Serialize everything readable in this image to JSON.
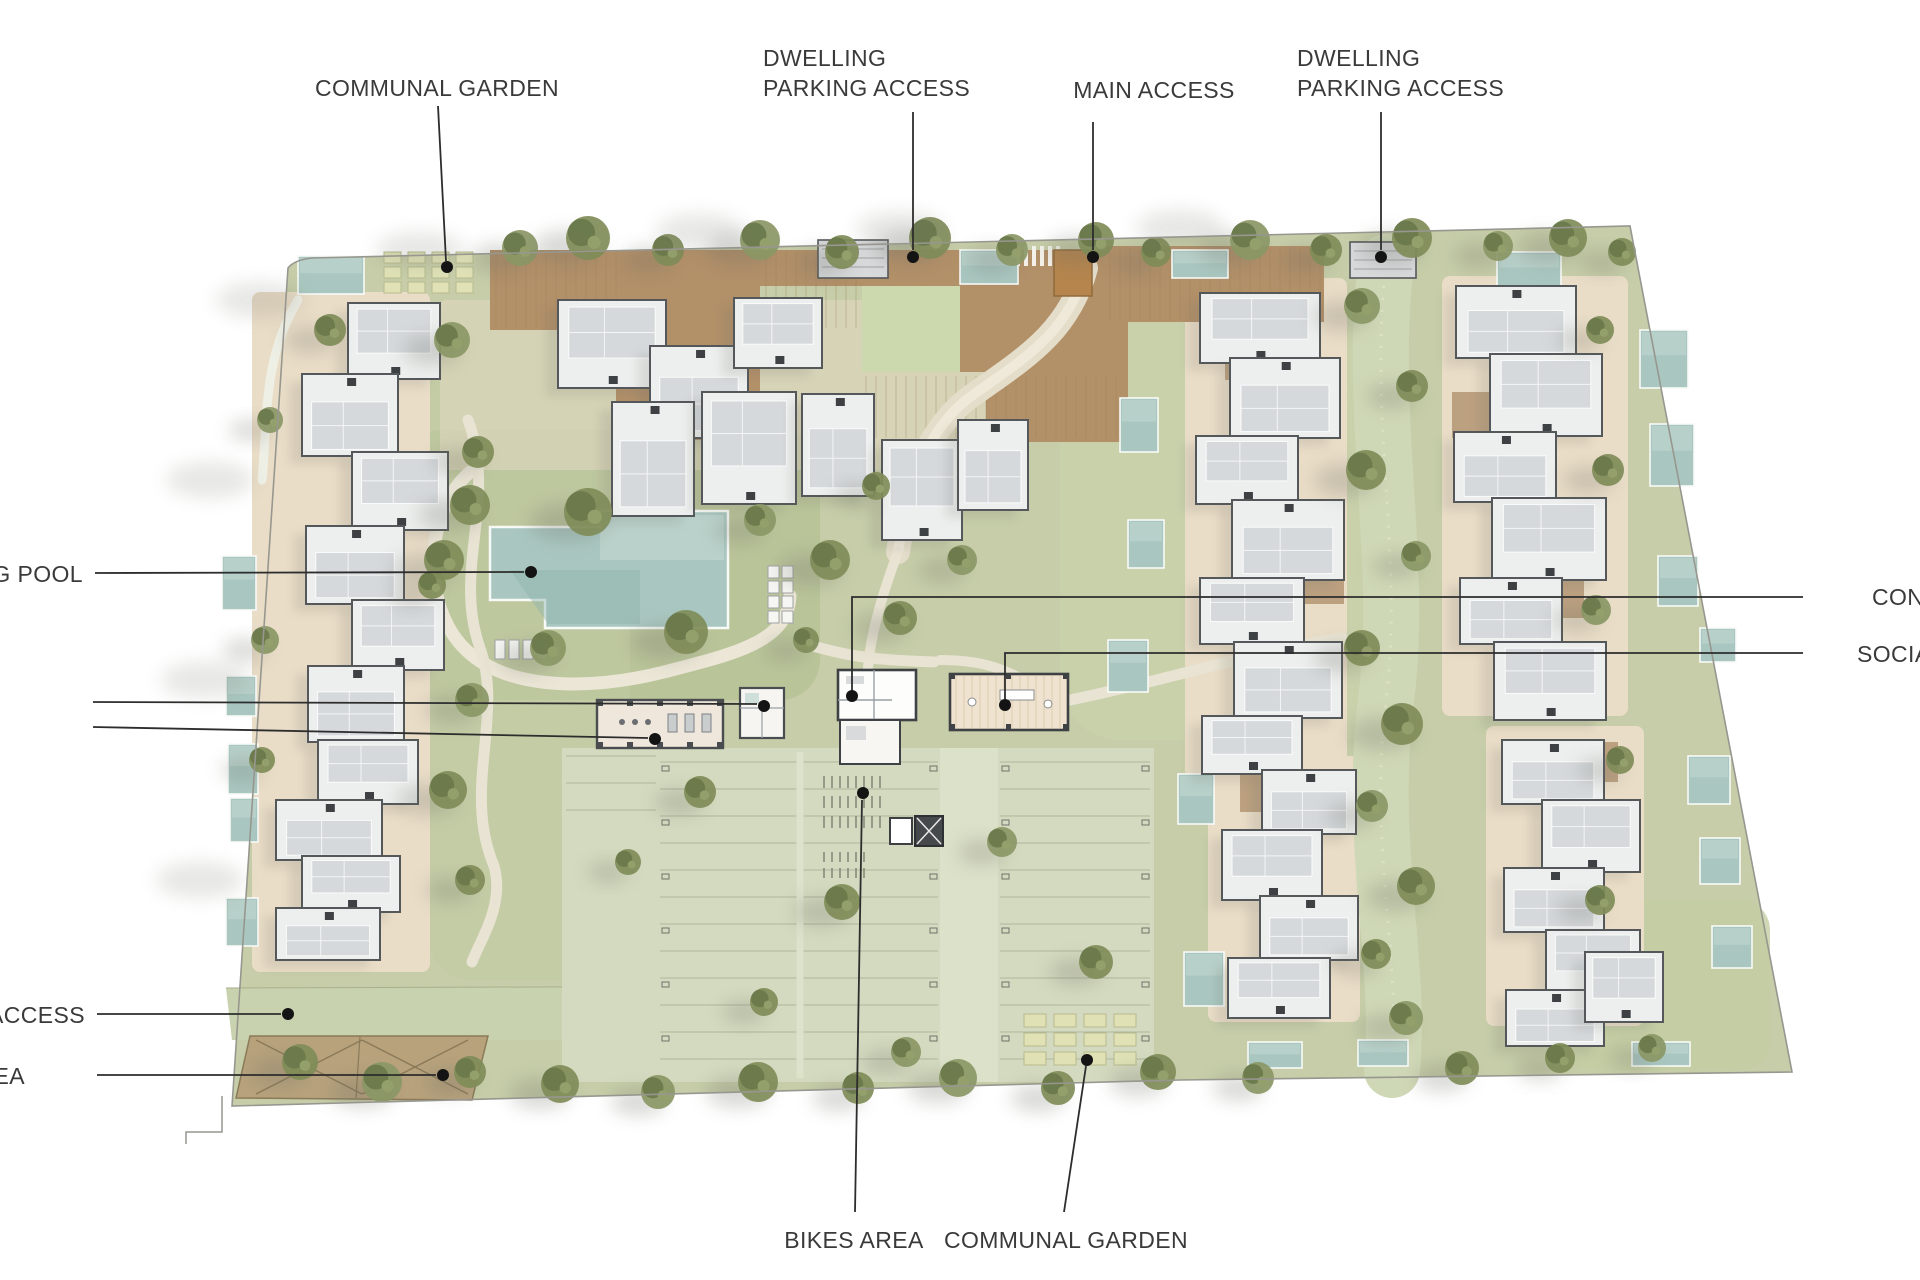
{
  "figure": {
    "kind": "residential masterplan site plan, top view render",
    "background": "#ffffff"
  },
  "palette": {
    "label_text": "#3a3a3a",
    "leader_line": "#2d2d2d",
    "dot": "#141414",
    "ground": "#c6cda8",
    "lawn": "#b6c296",
    "parking_surface": "#d4dabf",
    "path_cream": "#ebe6d6",
    "terrace_beige": "#e9ddc7",
    "deck_brown": "#b29068",
    "spine_green": "#cfd8b6",
    "pool_water": "#a9c7c0",
    "pool_light": "#c6d9d2",
    "building_fill": "#edefee",
    "building_roof": "#d5d9db",
    "building_stroke": "#54585a",
    "tree_green": "#7f8c58",
    "tree_dark": "#69784a",
    "shadow": "#6d6d66",
    "beds_fill": "#e0e2b6",
    "gate_orange": "#b5854d",
    "boundary": "#97978f"
  },
  "annotations": [
    {
      "name": "label-communal-garden-top",
      "lines": [
        "COMMUNAL GARDEN"
      ],
      "tx": 437,
      "ty": 88,
      "anchor": "middle",
      "leader": [
        [
          438,
          106
        ],
        [
          446,
          261
        ]
      ],
      "dot": [
        447,
        267
      ]
    },
    {
      "name": "label-dwelling-parking-access-left",
      "lines": [
        "DWELLING",
        "PARKING ACCESS"
      ],
      "tx": 763,
      "ty": 58,
      "anchor": "start",
      "leader": [
        [
          913,
          112
        ],
        [
          913,
          250
        ]
      ],
      "dot": [
        913,
        257
      ]
    },
    {
      "name": "label-main-access",
      "lines": [
        "MAIN ACCESS"
      ],
      "tx": 1154,
      "ty": 90,
      "anchor": "middle",
      "leader": [
        [
          1093,
          122
        ],
        [
          1093,
          250
        ]
      ],
      "dot": [
        1093,
        257
      ]
    },
    {
      "name": "label-dwelling-parking-access-right",
      "lines": [
        "DWELLING",
        "PARKING ACCESS"
      ],
      "tx": 1297,
      "ty": 58,
      "anchor": "start",
      "leader": [
        [
          1381,
          112
        ],
        [
          1381,
          250
        ]
      ],
      "dot": [
        1381,
        257
      ]
    },
    {
      "name": "label-swimming-pool",
      "lines": [
        "NG POOL"
      ],
      "tx": 83,
      "ty": 574,
      "anchor": "end",
      "leader": [
        [
          95,
          573
        ],
        [
          524,
          572
        ]
      ],
      "dot": [
        531,
        572
      ]
    },
    {
      "name": "label-concierge",
      "lines": [
        "CON"
      ],
      "tx": 1872,
      "ty": 597,
      "anchor": "start",
      "leader": [
        [
          1803,
          597
        ],
        [
          852,
          597
        ],
        [
          852,
          690
        ]
      ],
      "dot": [
        852,
        696
      ]
    },
    {
      "name": "label-social-club",
      "lines": [
        "SOCIA"
      ],
      "tx": 1857,
      "ty": 654,
      "anchor": "start",
      "leader": [
        [
          1803,
          653
        ],
        [
          1005,
          653
        ],
        [
          1005,
          699
        ]
      ],
      "dot": [
        1005,
        705
      ]
    },
    {
      "name": "leader-amenity-upper",
      "lines": [],
      "leader": [
        [
          93,
          702
        ],
        [
          757,
          704
        ]
      ],
      "dot": [
        764,
        706
      ]
    },
    {
      "name": "leader-amenity-lower",
      "lines": [],
      "leader": [
        [
          93,
          727
        ],
        [
          648,
          738
        ]
      ],
      "dot": [
        655,
        739
      ]
    },
    {
      "name": "label-access",
      "lines": [
        "ACCESS"
      ],
      "tx": 85,
      "ty": 1015,
      "anchor": "end",
      "leader": [
        [
          97,
          1014
        ],
        [
          281,
          1014
        ]
      ],
      "dot": [
        288,
        1014
      ]
    },
    {
      "name": "label-area",
      "lines": [
        "EA"
      ],
      "tx": 25,
      "ty": 1076,
      "anchor": "end",
      "leader": [
        [
          97,
          1075
        ],
        [
          436,
          1075
        ]
      ],
      "dot": [
        443,
        1075
      ]
    },
    {
      "name": "label-bikes-area",
      "lines": [
        "BIKES AREA"
      ],
      "tx": 854,
      "ty": 1240,
      "anchor": "middle",
      "leader": [
        [
          855,
          1212
        ],
        [
          862,
          800
        ]
      ],
      "dot": [
        863,
        793
      ]
    },
    {
      "name": "label-communal-garden-bottom",
      "lines": [
        "COMMUNAL GARDEN"
      ],
      "tx": 1066,
      "ty": 1240,
      "anchor": "middle",
      "leader": [
        [
          1064,
          1212
        ],
        [
          1086,
          1066
        ]
      ],
      "dot": [
        1087,
        1060
      ]
    }
  ],
  "features": [
    "communal-garden-top",
    "dwelling-parking-access-left",
    "main-access-gate",
    "dwelling-parking-access-right",
    "swimming-pool",
    "concierge-building",
    "social-club-building",
    "gym-building",
    "spa-building",
    "pedestrian-access-lane",
    "pergola-area",
    "bikes-area",
    "communal-garden-bottom",
    "parking-area",
    "residential-buildings",
    "private-pools",
    "stair-core",
    "elevator-core"
  ],
  "label_style": {
    "font_size_px": 23,
    "letter_spacing_px": 0.4,
    "line_height_px": 30,
    "dot_radius_px": 6,
    "line_width_px": 1.8
  }
}
